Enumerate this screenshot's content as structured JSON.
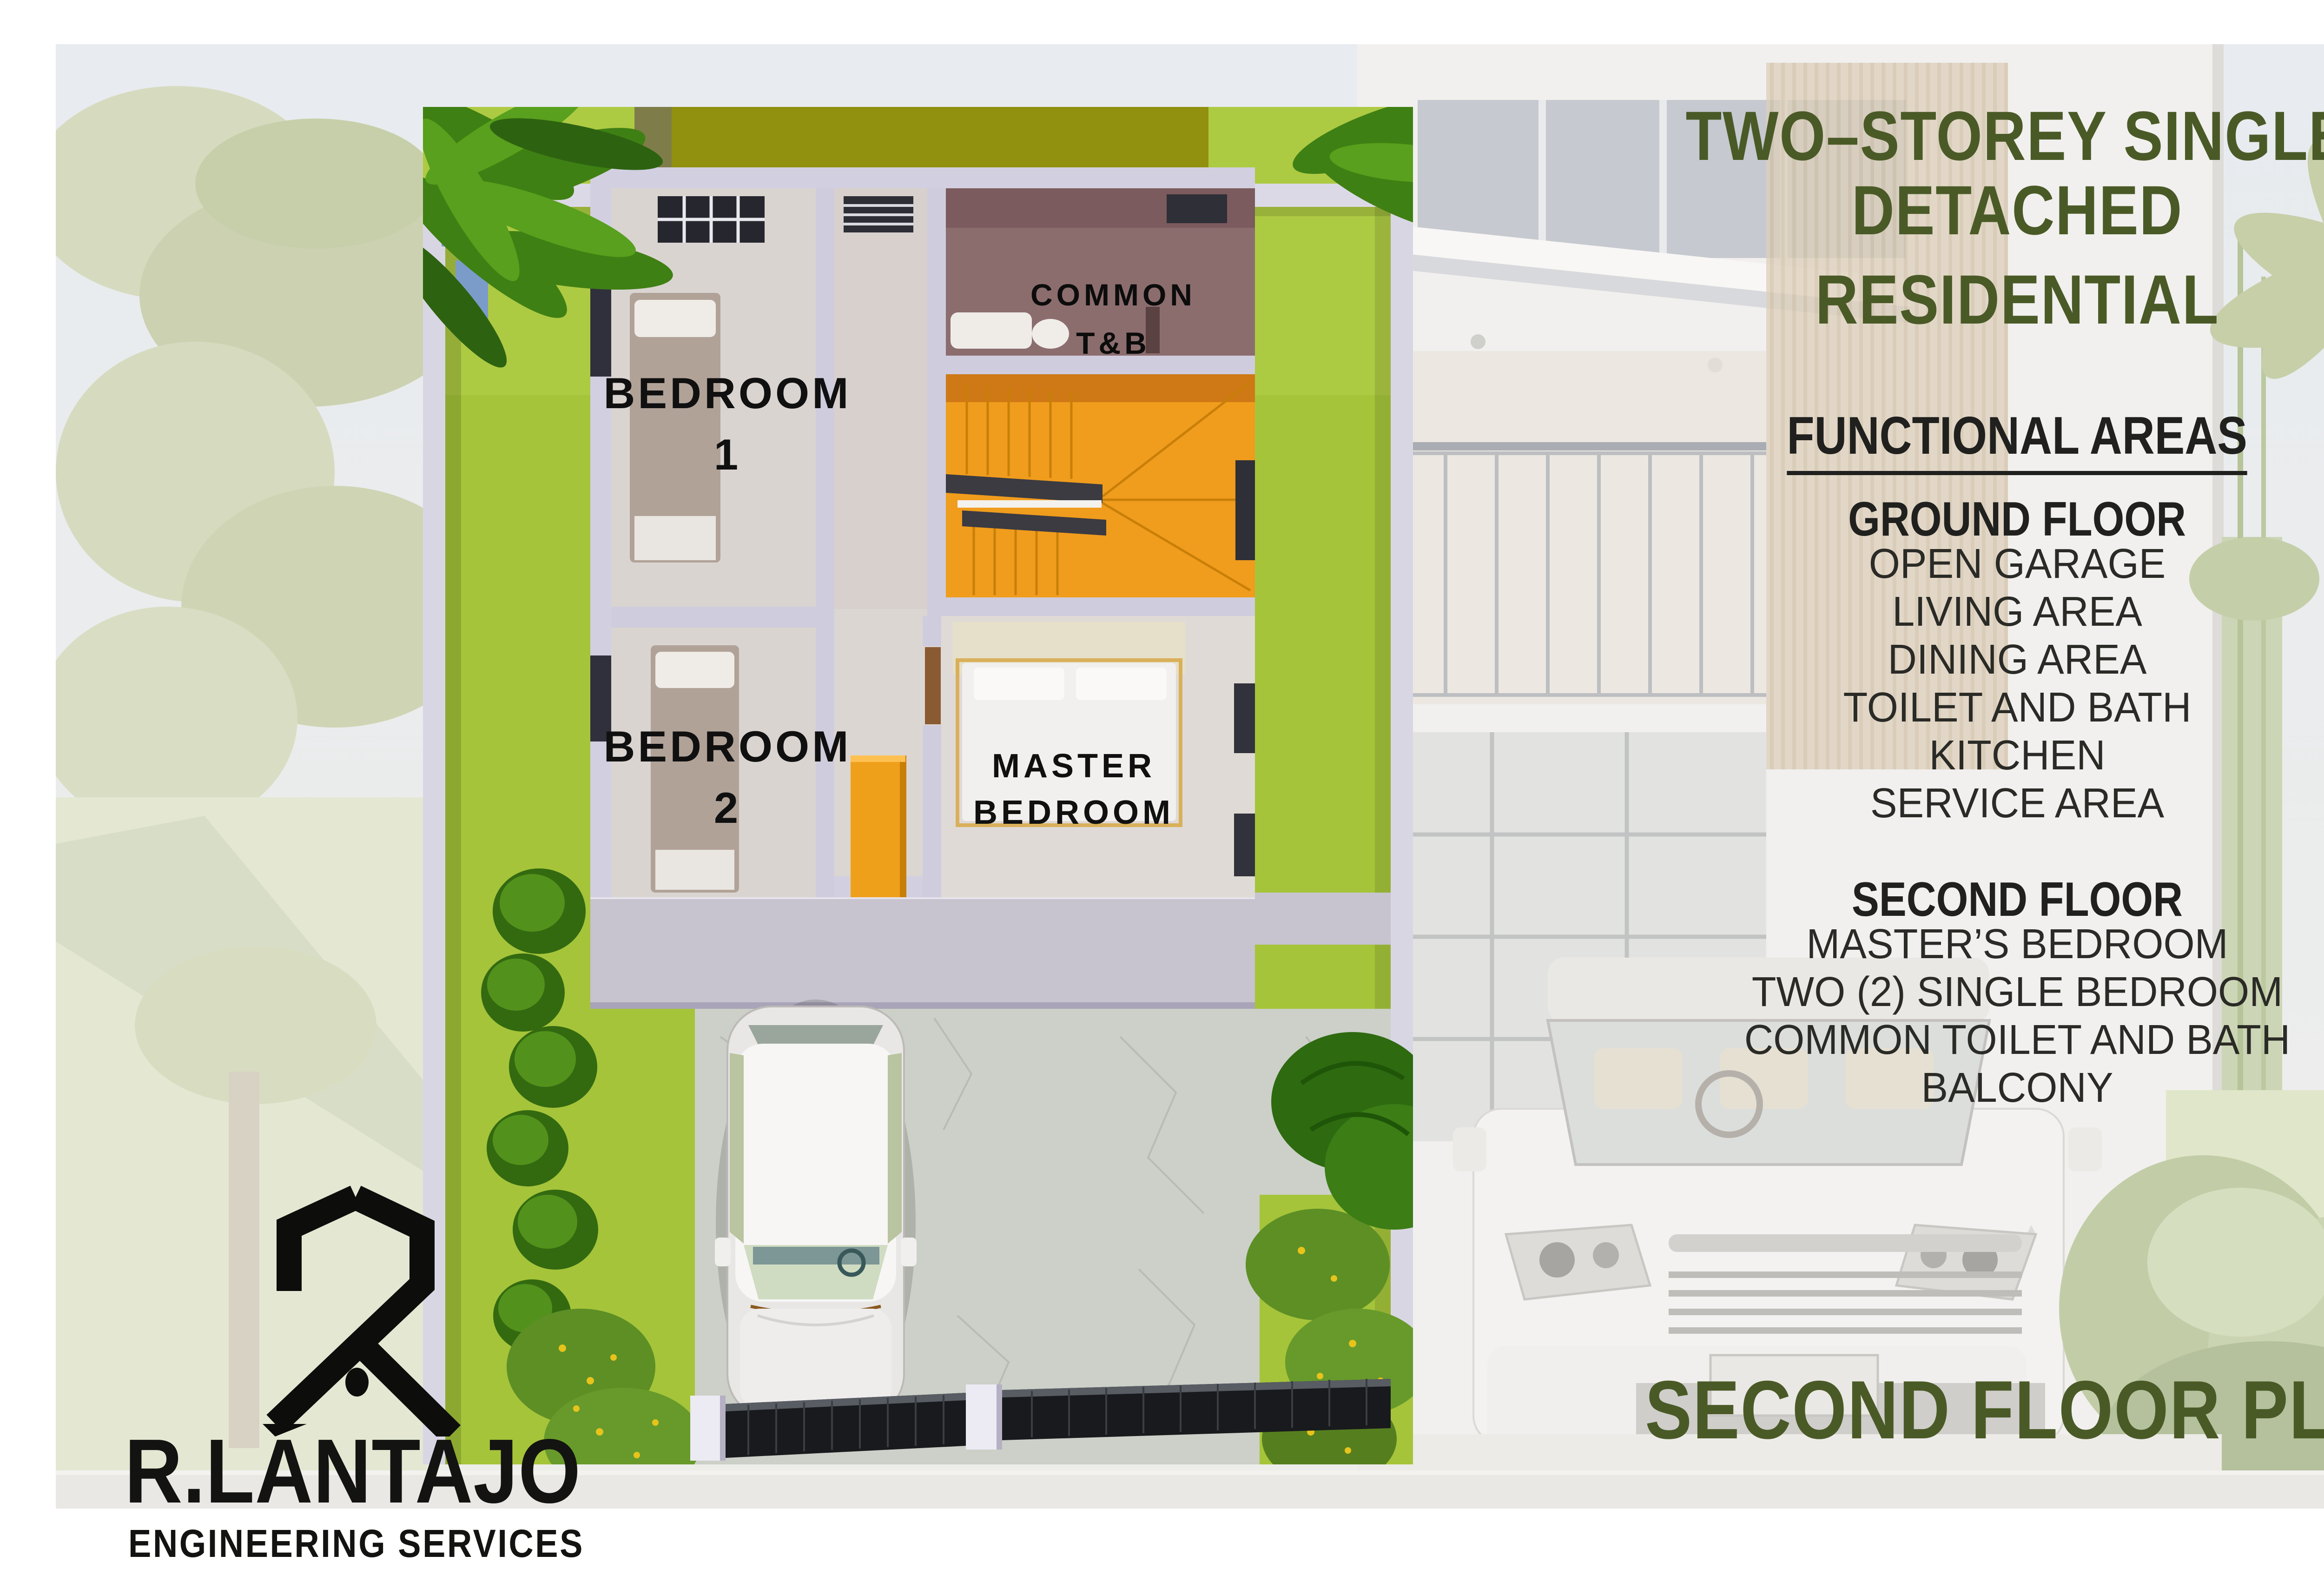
{
  "header": {
    "title_line1": "TWO–STOREY SINGLE DETACHED",
    "title_line2": "RESIDENTIAL"
  },
  "functional_areas": {
    "heading": "FUNCTIONAL AREAS",
    "ground_floor": {
      "heading": "GROUND FLOOR",
      "items": [
        "OPEN GARAGE",
        "LIVING AREA",
        "DINING AREA",
        "TOILET AND BATH",
        "KITCHEN",
        "SERVICE AREA"
      ]
    },
    "second_floor": {
      "heading": "SECOND FLOOR",
      "items": [
        "MASTER’S BEDROOM",
        "TWO (2) SINGLE BEDROOM",
        "COMMON TOILET AND BATH",
        "BALCONY"
      ]
    }
  },
  "plan_caption": "SECOND FLOOR PLAN",
  "floor_plan": {
    "labels": {
      "bedroom1_line1": "BEDROOM",
      "bedroom1_line2": "1",
      "bedroom2_line1": "BEDROOM",
      "bedroom2_line2": "2",
      "common_tb_line1": "COMMON",
      "common_tb_line2": "T&B",
      "master_line1": "MASTER",
      "master_line2": "BEDROOM"
    }
  },
  "logo": {
    "name": "R.LANTAJO",
    "tagline": "ENGINEERING SERVICES"
  },
  "colors": {
    "accent_olive": "#4a5a27",
    "text_black": "#20201e",
    "lawn_green": "#a5c43a",
    "stairs_orange": "#f09c1d",
    "wardrobe_yellow": "#efa01b",
    "tb_mauve": "#8c6d6e",
    "wall_lavender": "#d9d6e4",
    "gate_black": "#191a1d",
    "neighbor_olive_roof": "#91900f"
  }
}
